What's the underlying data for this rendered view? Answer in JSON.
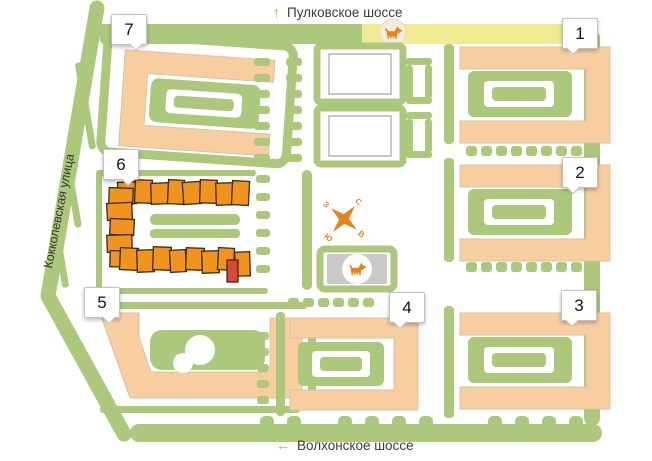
{
  "streets": {
    "top": {
      "arrow": "↑",
      "label": "Пулковское шоссе"
    },
    "bottom": {
      "arrow": "←",
      "label": "Волхонское шоссе"
    },
    "side": {
      "label": "Кокколевская улица"
    }
  },
  "compass": {
    "north": "С",
    "east": "В",
    "south": "Ю",
    "west": "З"
  },
  "markers": [
    {
      "label": "1"
    },
    {
      "label": "2"
    },
    {
      "label": "3"
    },
    {
      "label": "4"
    },
    {
      "label": "5"
    },
    {
      "label": "6"
    },
    {
      "label": "7"
    }
  ],
  "icons": {
    "dog_walk_area": "dog-icon",
    "dog_road_sign": "dog-icon"
  },
  "colors": {
    "greenery": "#abc87d",
    "building": "#f8cda0",
    "building_outline": "#d9c3a6",
    "highlighted_building": "#f0941f",
    "highlight_outline": "#3a2a14",
    "selected_section": "#d9473a",
    "road_yellow": "#f1eb94",
    "dog_area_gray": "#c9c9c9",
    "accent_orange": "#e8821e",
    "marker_border": "#c2c2c2",
    "text": "#3a3a3a"
  }
}
